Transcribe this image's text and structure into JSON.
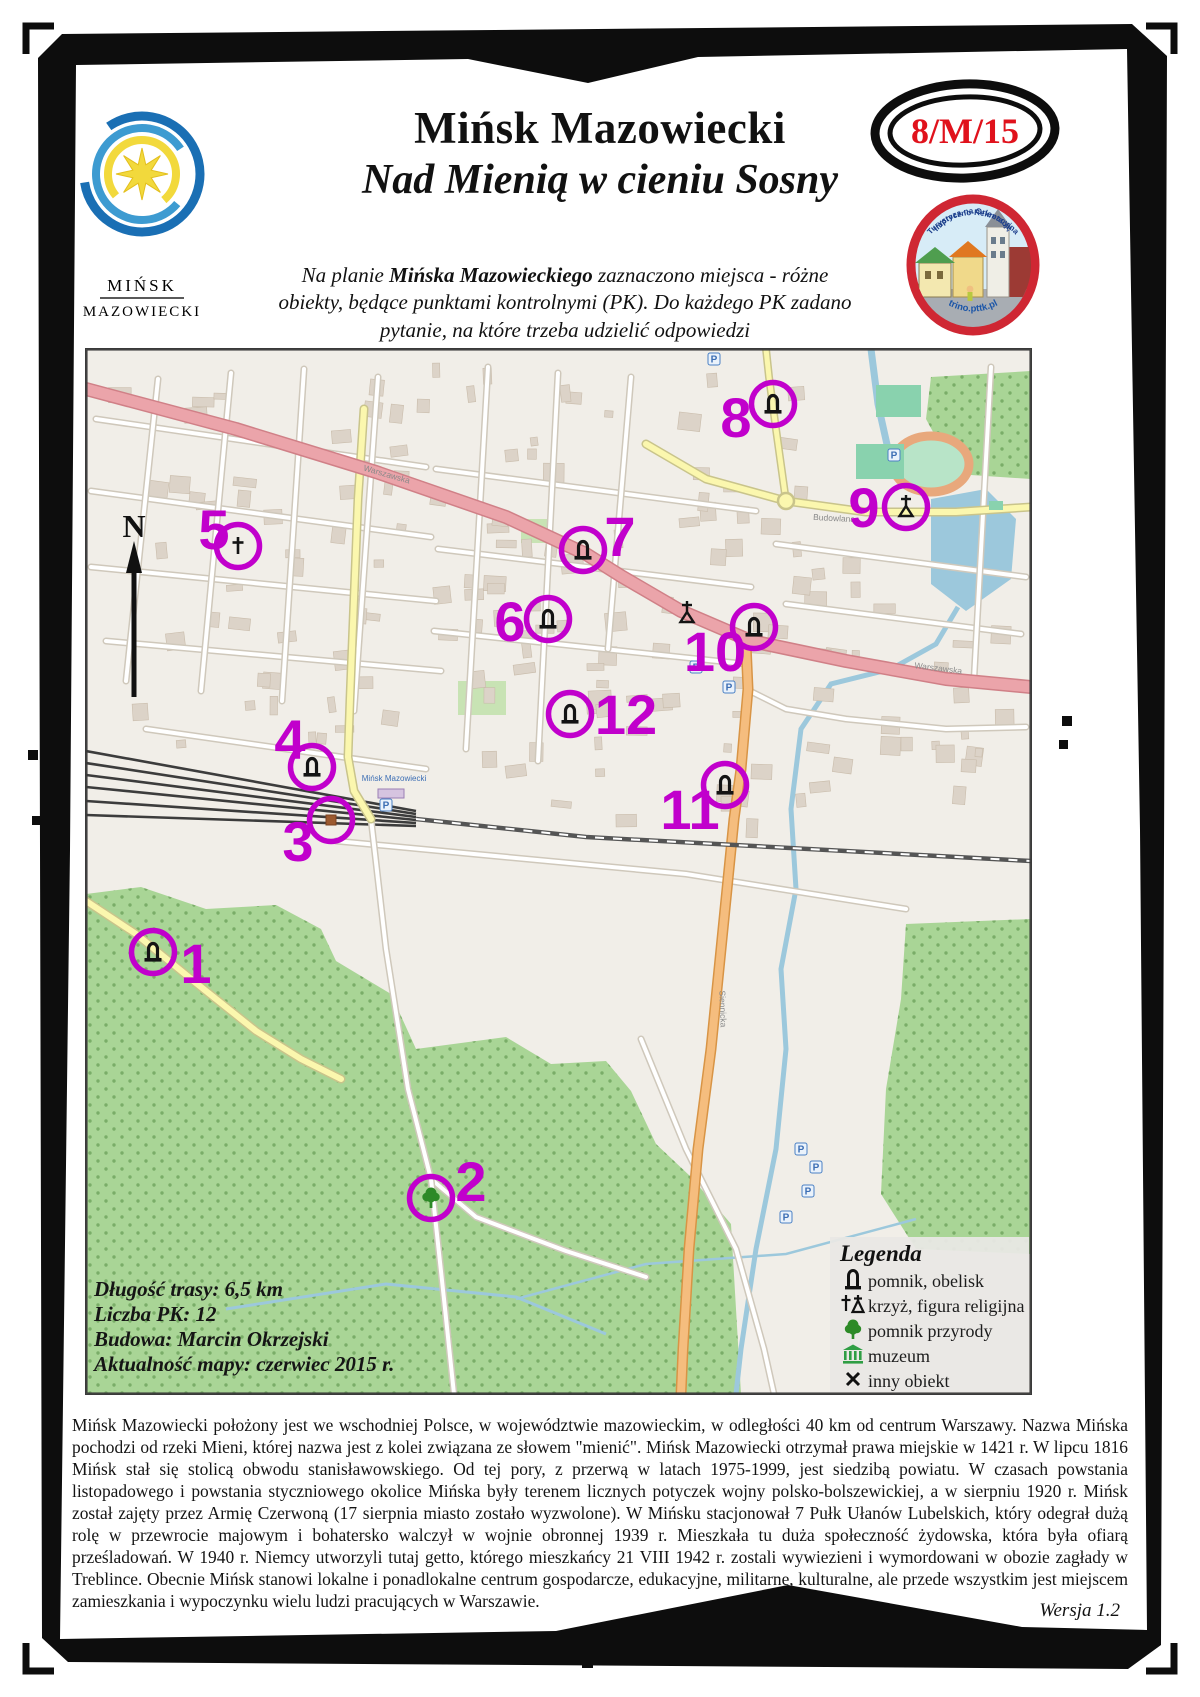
{
  "page": {
    "code_badge": "8/M/15",
    "version": "Wersja 1.2"
  },
  "header": {
    "city_logo": {
      "line1": "MIŃSK",
      "line2": "MAZOWIECKI"
    },
    "title": "Mińsk Mazowiecki",
    "subtitle": "Nad Mienią w cieniu Sosny",
    "intro_line1_pre": "Na planie ",
    "intro_line1_bold": "Mińska Mazowieckiego",
    "intro_line1_post": " zaznaczono miejsca - różne",
    "intro_line2": "obiekty, będące punktami kontrolnymi (PK). Do każdego PK zadano",
    "intro_line3": "pytanie, na które trzeba udzielić odpowiedzi",
    "trino_logo": {
      "arc_top": "Turystyczno-Rekreacyjna",
      "arc_mid": "Impreza na Orientację",
      "arc_bottom": "trino.pttk.pl"
    }
  },
  "map": {
    "compass": "N",
    "info": [
      {
        "label": "Długość trasy:",
        "value": "6,5 km",
        "bold": true
      },
      {
        "label": "Liczba PK:",
        "value": "12",
        "bold": true
      },
      {
        "label": "Budowa:",
        "value": "Marcin Okrzejski",
        "bold": true
      },
      {
        "label": "Aktualność mapy:",
        "value": "czerwiec 2015 r.",
        "bold": false
      }
    ],
    "legend": {
      "title": "Legenda",
      "items": [
        {
          "icon": "pomnik-icon",
          "label": "pomnik, obelisk"
        },
        {
          "icon": "krzyz-icon",
          "label": "krzyż, figura religijna"
        },
        {
          "icon": "tree-icon",
          "label": "pomnik przyrody"
        },
        {
          "icon": "muzeum-icon",
          "label": "muzeum"
        },
        {
          "icon": "inny-icon",
          "label": "inny obiekt"
        }
      ]
    },
    "street_labels": [
      {
        "text": "Warszawska",
        "x": 300,
        "y": 128,
        "angle": 16
      },
      {
        "text": "Warszawska",
        "x": 852,
        "y": 322,
        "angle": 7
      },
      {
        "text": "Budowlana",
        "x": 748,
        "y": 172,
        "angle": 3
      },
      {
        "text": "Siennicka",
        "x": 634,
        "y": 660,
        "angle": 88
      }
    ],
    "station_label": "Mińsk Mazowiecki",
    "control_points": [
      {
        "n": "1",
        "symbol": "pomnik",
        "cx": 67,
        "cy": 603,
        "lx": 110,
        "ly": 634
      },
      {
        "n": "2",
        "symbol": "tree",
        "cx": 345,
        "cy": 849,
        "lx": 385,
        "ly": 852
      },
      {
        "n": "3",
        "symbol": "building",
        "cx": 245,
        "cy": 471,
        "lx": 212,
        "ly": 512
      },
      {
        "n": "4",
        "symbol": "pomnik",
        "cx": 226,
        "cy": 418,
        "lx": 204,
        "ly": 410
      },
      {
        "n": "5",
        "symbol": "cross",
        "cx": 152,
        "cy": 197,
        "lx": 128,
        "ly": 200
      },
      {
        "n": "6",
        "symbol": "pomnik",
        "cx": 462,
        "cy": 270,
        "lx": 424,
        "ly": 292
      },
      {
        "n": "7",
        "symbol": "pomnik",
        "cx": 497,
        "cy": 201,
        "lx": 534,
        "ly": 207
      },
      {
        "n": "8",
        "symbol": "pomnik",
        "cx": 687,
        "cy": 55,
        "lx": 650,
        "ly": 88
      },
      {
        "n": "9",
        "symbol": "krzyz",
        "cx": 820,
        "cy": 158,
        "lx": 778,
        "ly": 178
      },
      {
        "n": "10",
        "symbol": "pomnik",
        "cx": 668,
        "cy": 278,
        "lx": 629,
        "ly": 322
      },
      {
        "n": "11",
        "symbol": "pomnik",
        "cx": 639,
        "cy": 436,
        "lx": 604,
        "ly": 480
      },
      {
        "n": "12",
        "symbol": "pomnik",
        "cx": 484,
        "cy": 365,
        "lx": 540,
        "ly": 385
      }
    ]
  },
  "description": "Mińsk Mazowiecki położony jest we wschodniej Polsce, w województwie mazowieckim, w odległości 40 km od centrum Warszawy. Nazwa Mińska pochodzi od rzeki Mieni, której nazwa jest z kolei związana ze słowem \"mienić\". Mińsk Mazowiecki otrzymał prawa miejskie w 1421 r. W lipcu 1816 Mińsk stał się stolicą obwodu stanisławowskiego. Od tej pory, z przerwą w latach 1975-1999, jest siedzibą powiatu. W czasach powstania listopadowego i powstania styczniowego okolice Mińska były terenem licznych potyczek wojny polsko-bolszewickiej, a w sierpniu 1920 r. Mińsk został zajęty przez Armię Czerwoną (17 sierpnia miasto zostało wyzwolone). W Mińsku stacjonował 7 Pułk Ułanów Lubelskich, który odegrał dużą rolę w przewrocie majowym i bohatersko walczył w wojnie obronnej 1939 r. Mieszkała tu duża społeczność żydowska, która była ofiarą prześladowań. W 1940 r. Niemcy utworzyli tutaj getto, którego mieszkańcy 21 VIII 1942 r. zostali wywiezieni i wymordowani w obozie zagłady w Treblince. Obecnie Mińsk stanowi lokalne i ponadlokalne centrum gospodarcze, edukacyjne, militarne, kulturalne, ale przede wszystkim jest miejscem zamieszkania i wypoczynku wielu ludzi pracujących w Warszawie.",
  "colors": {
    "accent": "#c100cc",
    "base": "#f1eee8",
    "forest": "#a9d596",
    "forest_dot": "#7aad68",
    "water": "#9cc8dc",
    "road_trunk": "#eba4aa",
    "road_trunk_border": "#d08087",
    "road_orange": "#f5bd7e",
    "road_orange_border": "#d89445",
    "road_yellow": "#fbf7ae",
    "road_yellow_border": "#c9c48b",
    "road_white": "#ffffff",
    "road_white_border": "#cfc8bb",
    "building": "#dcd3c8",
    "building_border": "#c9bcab",
    "pitch": "#89d2ae",
    "track": "#e8a87c",
    "rail": "#4a4a4a",
    "badge_red": "#e0121c"
  }
}
